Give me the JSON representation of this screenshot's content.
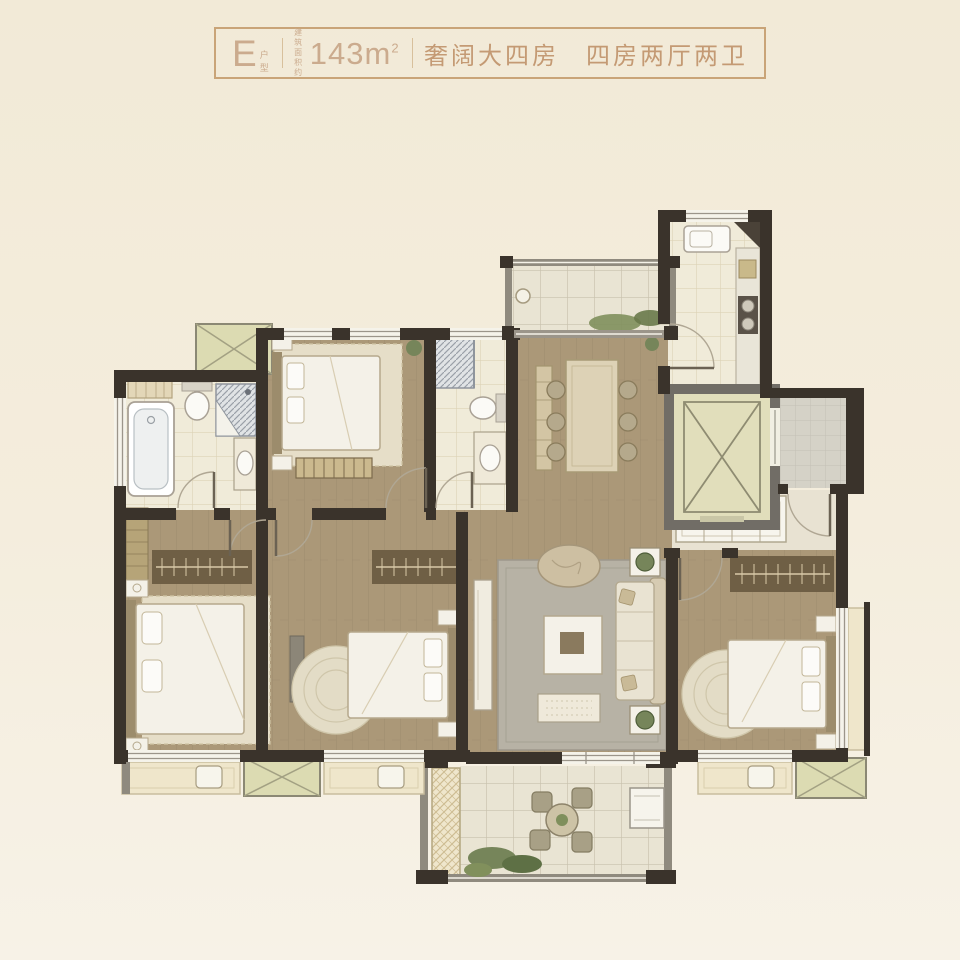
{
  "header": {
    "unit_letter": "E",
    "unit_label": "户型",
    "area_label_line1": "建筑",
    "area_label_line2": "面积约",
    "area_value": "143m",
    "area_unit_sup": "2",
    "tagline": "奢阔大四房　四房两厅两卫"
  },
  "colors": {
    "page_bg": "#f3ecdb",
    "accent": "#c6a07c",
    "wall": "#3a332b",
    "gray_wall": "#716d66",
    "wood_floor": "#ab9878",
    "tile_floor": "#f0ebd9",
    "balcony_tile": "#e9e4d3",
    "platform_green": "#dcdbb2",
    "rug_gray": "#b7b2a5",
    "plant_green": "#76855a"
  }
}
